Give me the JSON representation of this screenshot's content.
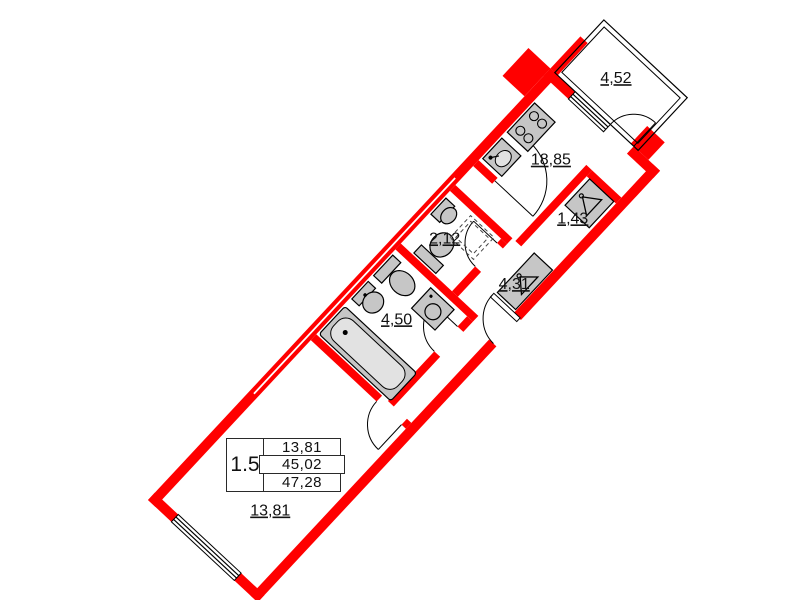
{
  "plan": {
    "title": "apartment-floor-plan",
    "apartment_type_label": "1.5",
    "spec_table": {
      "type_label": "1.5",
      "living_area": "13,81",
      "apartment_area": "45,02",
      "total_area": "47,28"
    },
    "rooms": [
      {
        "name": "living-room",
        "area": "13,81"
      },
      {
        "name": "bathroom",
        "area": "4,50"
      },
      {
        "name": "wc",
        "area": "2,12"
      },
      {
        "name": "corridor",
        "area": "4,31"
      },
      {
        "name": "entry-hall",
        "area": "1,43"
      },
      {
        "name": "kitchen-living",
        "area": "18,85"
      },
      {
        "name": "balcony",
        "area": "4,52"
      }
    ],
    "fixtures": [
      "bathtub",
      "sink",
      "toilet",
      "washing-machine",
      "stove",
      "kitchen-sink",
      "wardrobe-hanger",
      "door-swing",
      "window"
    ],
    "colors": {
      "wall": "#ff0000",
      "fixture_fill": "#c6c6c6",
      "line": "#000000",
      "background": "#ffffff"
    }
  }
}
